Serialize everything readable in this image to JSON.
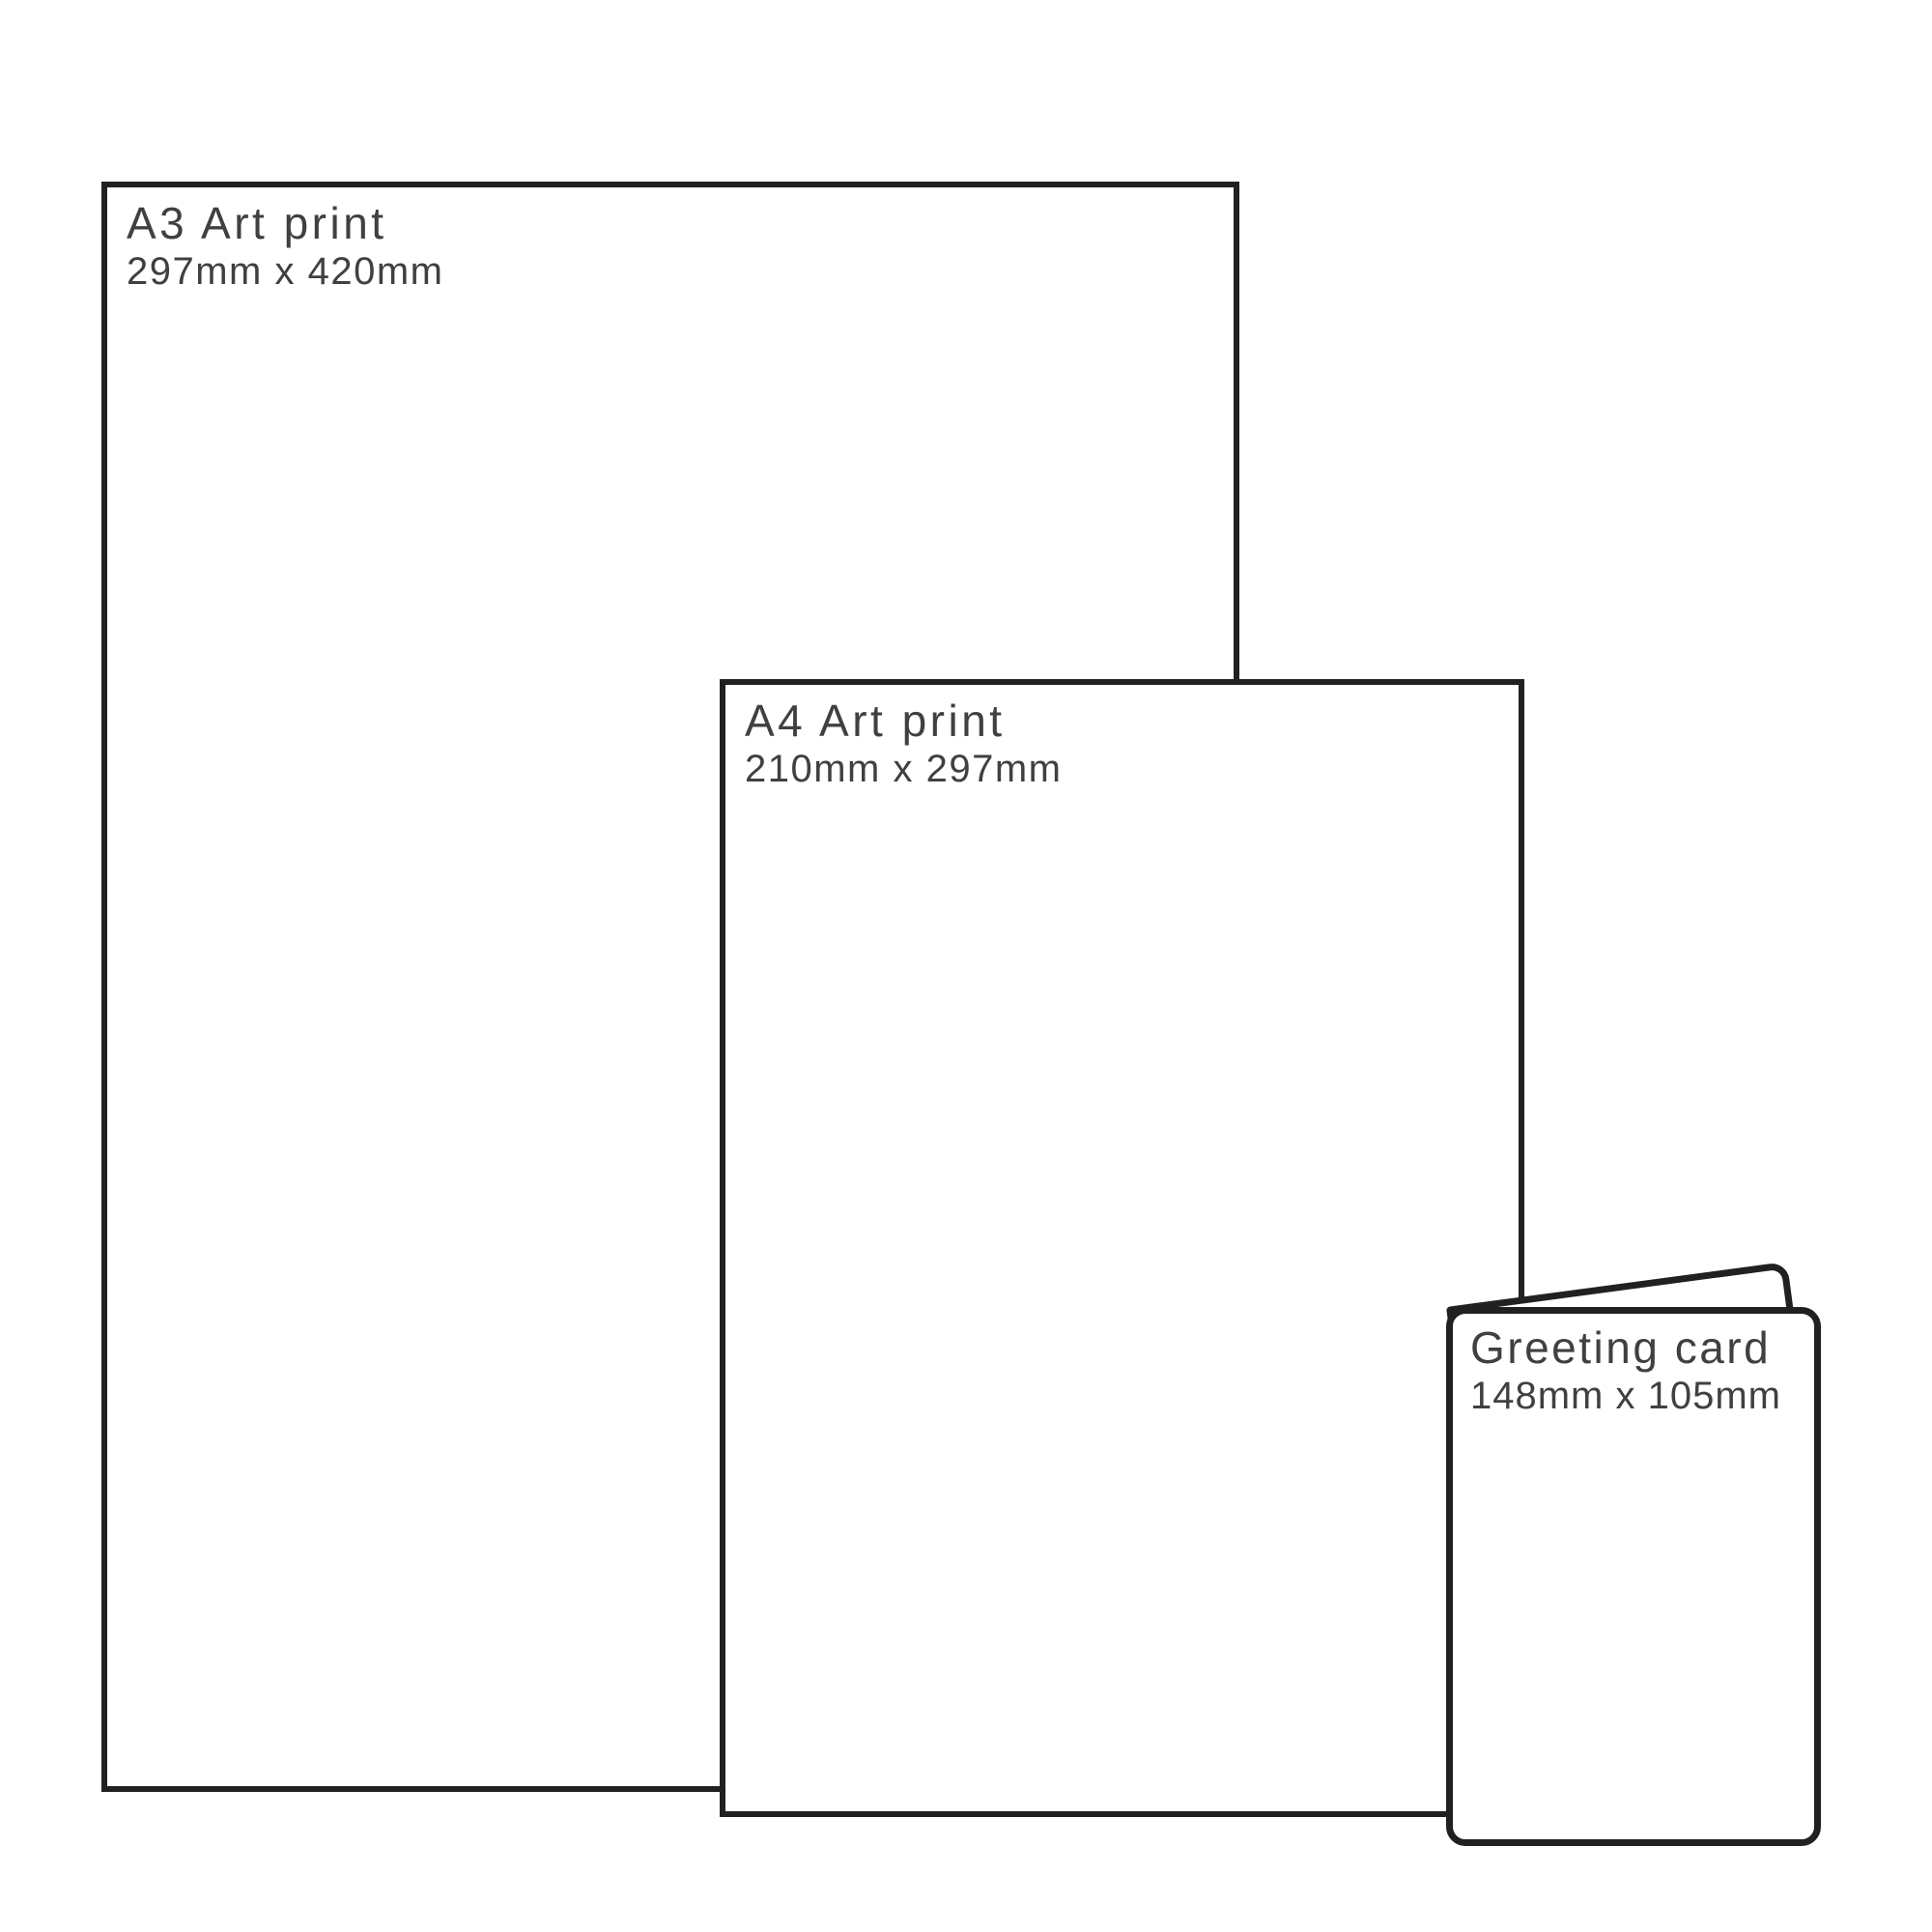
{
  "diagram": {
    "description_colors": {
      "background": "#ffffff",
      "outline": "#212121",
      "text": "#404040"
    },
    "items": [
      {
        "id": "a3",
        "title": "A3 Art print",
        "dimensions": "297mm x 420mm"
      },
      {
        "id": "a4",
        "title": "A4 Art print",
        "dimensions": "210mm x 297mm"
      },
      {
        "id": "greeting-card",
        "title": "Greeting card",
        "dimensions": "148mm x 105mm"
      }
    ]
  }
}
